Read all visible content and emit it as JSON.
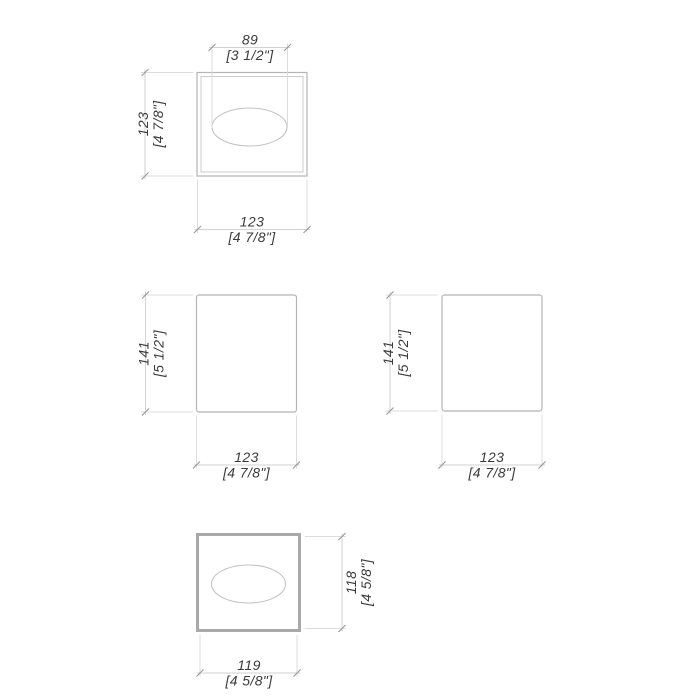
{
  "page": {
    "description": "Technical dimension drawing of a square tissue box cover shown in four orthographic views (top, front, side, bottom) with millimetre values and inch values in brackets"
  },
  "views": {
    "top": {
      "label": "top-view",
      "opening_width": {
        "mm": "89",
        "inch": "[3 1/2\"]"
      },
      "depth": {
        "mm": "123",
        "inch": "[4 7/8\"]"
      },
      "width": {
        "mm": "123",
        "inch": "[4 7/8\"]"
      }
    },
    "front": {
      "label": "front-view",
      "height": {
        "mm": "141",
        "inch": "[5 1/2\"]"
      },
      "width": {
        "mm": "123",
        "inch": "[4 7/8\"]"
      }
    },
    "side": {
      "label": "side-view",
      "height": {
        "mm": "141",
        "inch": "[5 1/2\"]"
      },
      "width": {
        "mm": "123",
        "inch": "[4 7/8\"]"
      }
    },
    "bottom": {
      "label": "bottom-view",
      "depth": {
        "mm": "118",
        "inch": "[4 5/8\"]"
      },
      "width": {
        "mm": "119",
        "inch": "[4 5/8\"]"
      }
    }
  },
  "colors": {
    "background": "#ffffff",
    "outline": "#b5b5b5",
    "outline_thick": "#a9a9a9",
    "inner_line": "#cccccc",
    "ellipse_line": "#c3c3c3",
    "ext_line": "#dcdcdc",
    "dim_line": "#d2d2d2",
    "tick": "#979797",
    "text": "#3b3b3b"
  }
}
